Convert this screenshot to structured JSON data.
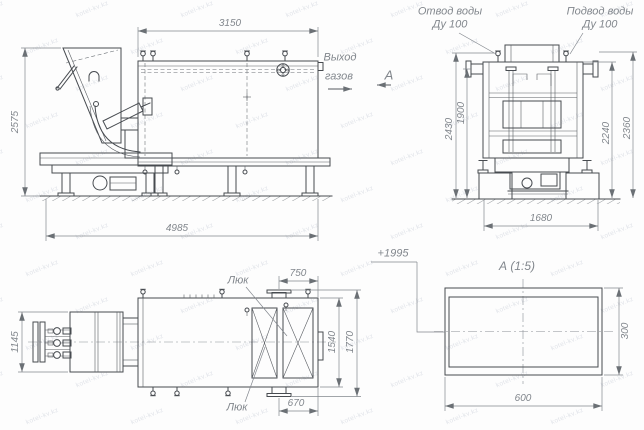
{
  "watermark": {
    "text": "kotel-kv.kz"
  },
  "side_view": {
    "dim_width_top": "3150",
    "dim_height_left": "2575",
    "dim_length_bottom": "4985",
    "gas_outlet_line1": "Выход",
    "gas_outlet_line2": "газов",
    "section_arrow_label": "А"
  },
  "end_view": {
    "water_outlet_line1": "Отвод воды",
    "water_outlet_line2": "Ду 100",
    "water_inlet_line1": "Подвод воды",
    "water_inlet_line2": "Ду 100",
    "dim_outer_left": "2430",
    "dim_inner_left": "1900",
    "dim_inner_right": "2240",
    "dim_outer_right": "2360",
    "dim_foundation": "1680"
  },
  "plan_view": {
    "dim_feeder": "1145",
    "dim_top_stub": "750",
    "dim_bottom_stub": "670",
    "dim_body": "1540",
    "dim_overall": "1770",
    "hatch_top": "Люк",
    "hatch_bottom": "Люк"
  },
  "detail_view": {
    "title": "А (1:5)",
    "elevation": "+1995",
    "dim_width": "600",
    "dim_height": "300"
  }
}
